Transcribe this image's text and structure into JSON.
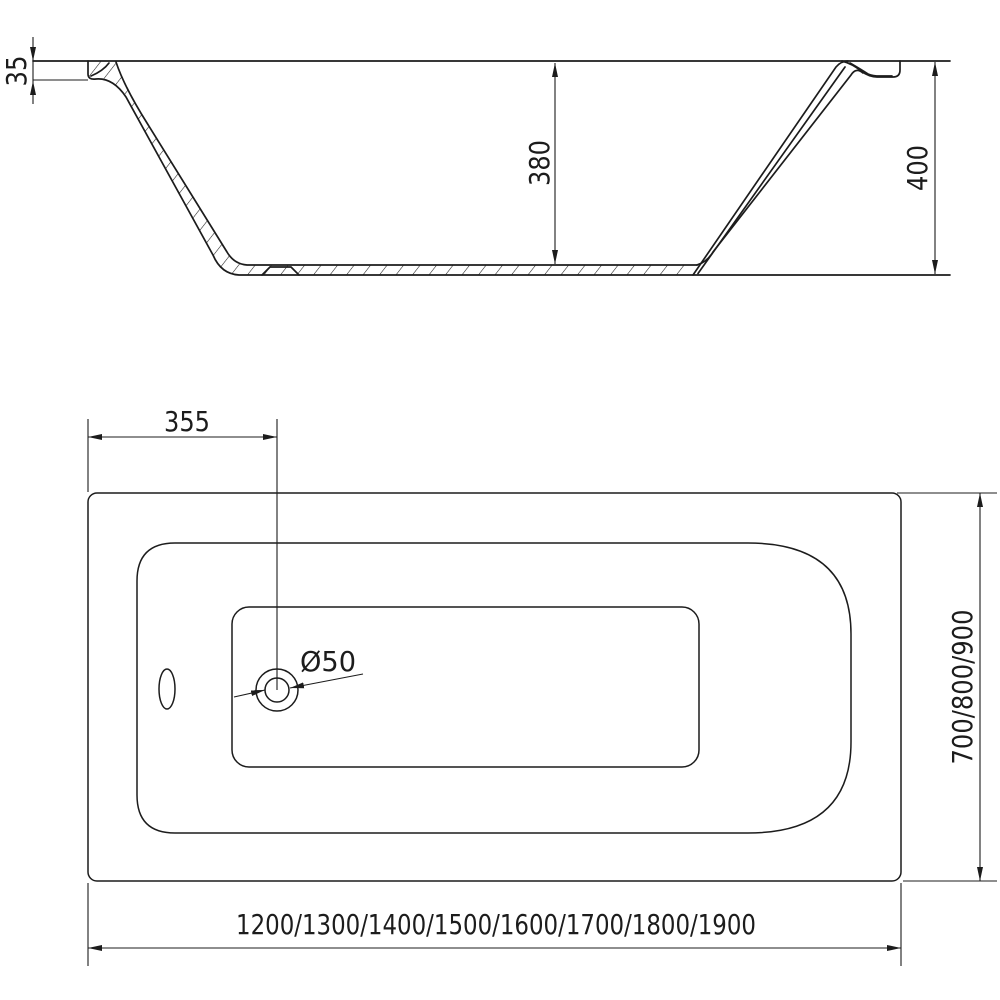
{
  "drawing": {
    "type": "bathtub technical drawing, two orthographic views",
    "side_view": {
      "dim_rim_height": "35",
      "dim_inner_depth": "380",
      "dim_total_height": "400"
    },
    "plan_view": {
      "dim_drain_offset": "355",
      "dim_drain_diameter": "Ø50",
      "dim_length_options": "1200/1300/1400/1500/1600/1700/1800/1900",
      "dim_width_options": "700/800/900"
    },
    "colors": {
      "line": "#1c1c1c",
      "background": "#ffffff"
    }
  }
}
